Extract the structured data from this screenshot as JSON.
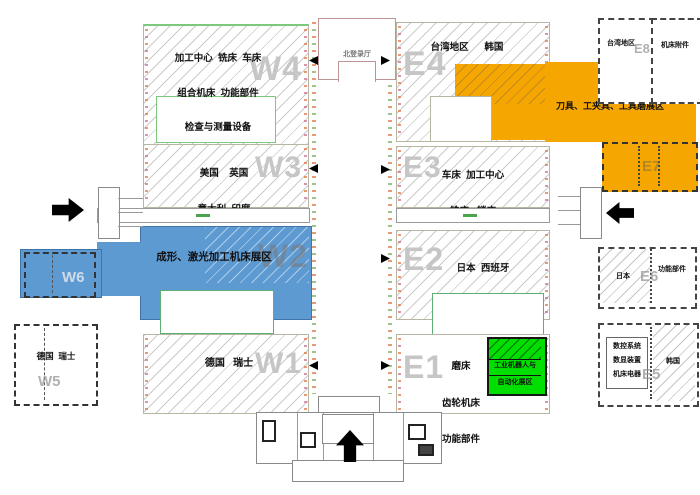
{
  "halls": {
    "w4": {
      "label": "W4",
      "lines": [
        "加工中心  铣床  车床",
        "组合机床  功能部件",
        "检查与测量设备",
        "超硬材料及磨料磨具"
      ]
    },
    "w3": {
      "label": "W3",
      "lines": [
        "美国    英国",
        "意大利  印度",
        "香港地区"
      ]
    },
    "w2": {
      "label": "W2"
    },
    "w1": {
      "label": "W1",
      "countries": "德国   瑞士"
    },
    "w5": {
      "label": "W5",
      "countries": "德国  瑞士"
    },
    "w6": {
      "label": "W6"
    },
    "e4": {
      "label": "E4",
      "countries": "台湾地区      韩国"
    },
    "e3": {
      "label": "E3",
      "lines": [
        "车床  加工中心",
        "铣床   镗床",
        "电加工机床"
      ]
    },
    "e2": {
      "label": "E2",
      "lines": [
        "日本  西班牙",
        "捷克   法国"
      ]
    },
    "e1": {
      "label": "E1",
      "lines": [
        "磨床",
        "齿轮机床",
        "功能部件"
      ]
    },
    "e5": {
      "label": "E5",
      "left_lines": [
        "数控系统",
        "数显装置",
        "机床电器"
      ],
      "right": "韩国"
    },
    "e6": {
      "label": "E6",
      "left": "日本",
      "right": "功能部件"
    },
    "e7": {
      "label": "E7"
    },
    "e8": {
      "label": "E8",
      "area": "台湾地区"
    },
    "accessory_box": {
      "name": "机床附件"
    }
  },
  "zones": {
    "forming": {
      "text": "成形、激光加工机床展区",
      "color": "#5D9AD2"
    },
    "tools": {
      "text": "刀具、工夹具、工具磨展区",
      "color": "#F6A600"
    },
    "robot": {
      "line1": "工业机器人与",
      "line2": "自动化展区",
      "color": "#00DF00"
    }
  },
  "landmarks": {
    "north_hall": "北登录厅"
  }
}
